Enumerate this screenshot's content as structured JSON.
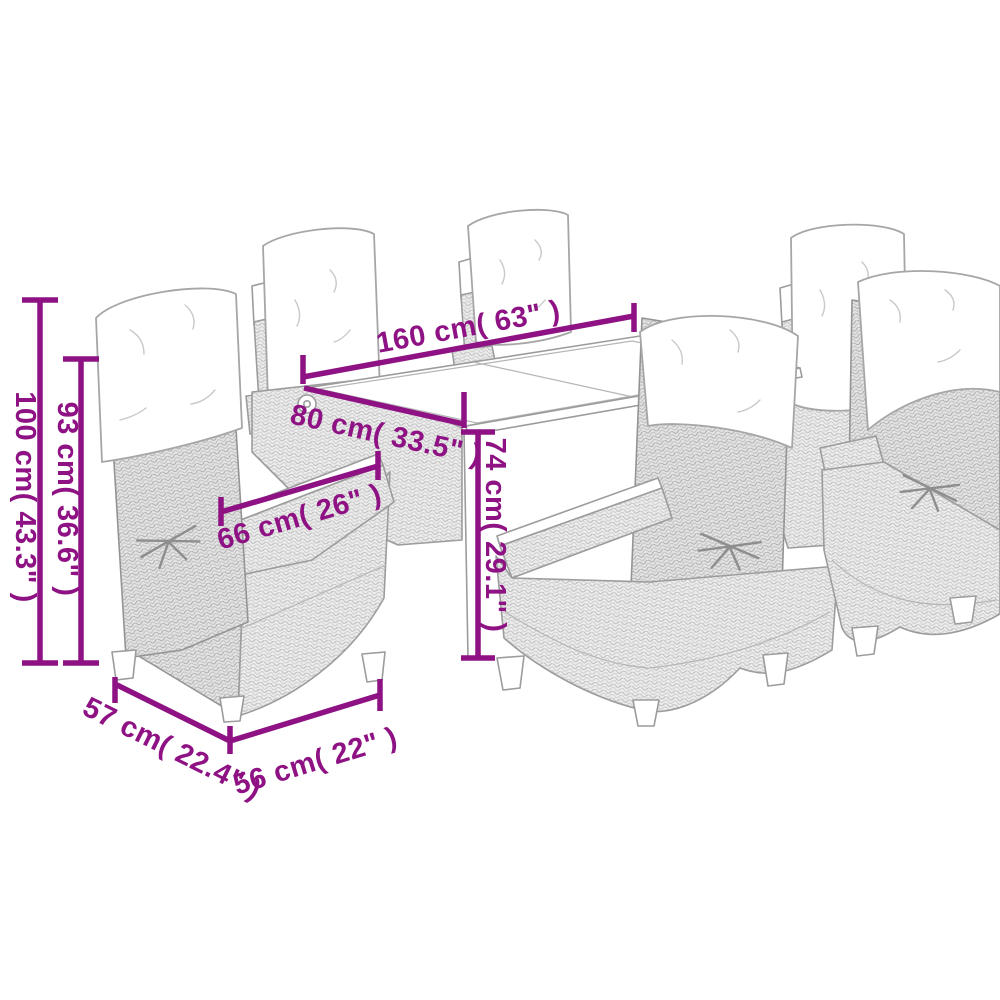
{
  "diagram": {
    "subject": "rattan garden dining set with table and six reclining chairs - dimension drawing",
    "background_color": "#ffffff",
    "annotation_color": "#8E1283",
    "line_art_color": "#9c9c9c",
    "dimensions": {
      "table_length": "160 cm( 63\" )",
      "table_depth": "80 cm( 33.5\" )",
      "table_height": "74 cm( 29.1\" )",
      "armrest_width": "66 cm( 26\" )",
      "chair_backrest_height": "93 cm( 36.6\" )",
      "chair_total_height": "100 cm( 43.3\" )",
      "chair_seat_depth": "57 cm( 22.4\" )",
      "chair_seat_width": "56 cm( 22\" )"
    }
  }
}
